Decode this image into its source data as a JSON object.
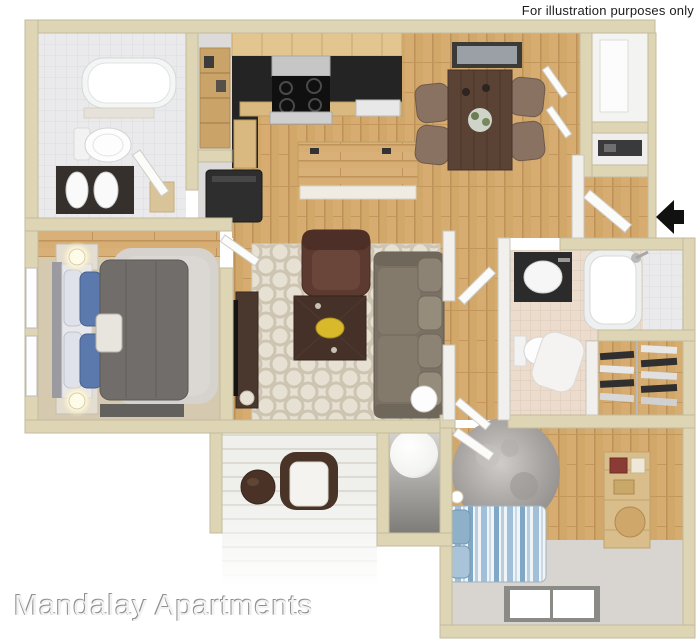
{
  "watermark": {
    "text": "For illustration purposes only"
  },
  "brand": {
    "text": "Mandalay Apartments"
  },
  "entry": {
    "arrow_icon": "left-arrow"
  },
  "palette": {
    "wall": "#ddd5b4",
    "wood_floor": "#d2a76a",
    "bath_tile": "#eaeaec",
    "bath2_tile": "#ecdccd",
    "master_carpet": "#d5cab0",
    "bedroom2_carpet": "#d8d5d0",
    "rug_cream": "#e7e1d4",
    "sofa": "#7a7164",
    "armchair": "#5d3a30",
    "dining_table": "#5a4234",
    "counter": "#242424",
    "bowl_accent": "#d9b92c",
    "bed_blue": "#5b79ac",
    "stripe_blue": "#7fa8c6",
    "arrow": "#111111"
  }
}
